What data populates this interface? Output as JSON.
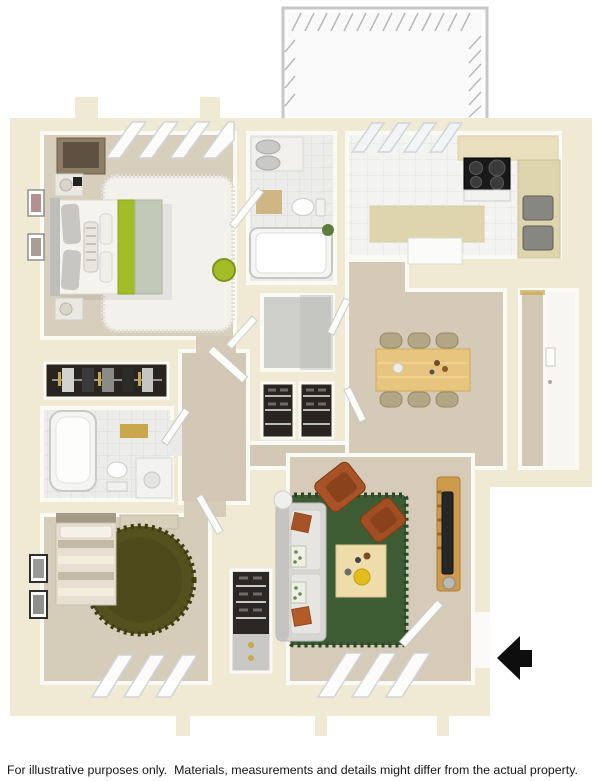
{
  "disclaimer": "For illustrative purposes only.  Materials, measurements and details might differ from the actual property.",
  "palette": {
    "background": "#ffffff",
    "wall_cream": "#f0ead5",
    "wall_face_white": "#fafaf5",
    "carpet_tan": "#d6ccba",
    "tile_white": "#ececea",
    "kitchen_tile": "#f3f3f1",
    "counter_beige": "#ded4ad",
    "wood_light": "#e7c57f",
    "lime_green": "#a3bd28",
    "sage_green": "#c3c9b8",
    "living_rug_green": "#3d5c33",
    "olive_rug": "#55511f",
    "rust_orange": "#a85327",
    "sofa_gray": "#d7d6d2",
    "closet_dark": "#29241f",
    "appliance_black": "#191919",
    "railing_gray": "#c7c7c7",
    "gold_accent": "#c9a84c",
    "arrow_black": "#0e0e0e"
  },
  "floor_plan": {
    "view": "3D top-down apartment floor plan rendering",
    "entry_arrow": {
      "direction": "left",
      "location": "outside right wall at entry door"
    },
    "rooms": [
      {
        "name": "balcony",
        "features": [
          "white deck",
          "railing with hatch marks"
        ]
      },
      {
        "name": "master-bedroom",
        "features": [
          "double bed with lime green runner",
          "white shag rug",
          "two nightstands with lamps",
          "dresser",
          "two wall art frames",
          "lime pouf",
          "windows on top wall"
        ]
      },
      {
        "name": "bathroom-1",
        "features": [
          "vanity with twin gray basins",
          "toilet",
          "bathtub",
          "plant",
          "tile floor",
          "open door"
        ]
      },
      {
        "name": "kitchen",
        "features": [
          "island counter",
          "black cooktop with oven",
          "double sink",
          "refrigerator",
          "white tile floor",
          "sliding glass door to balcony"
        ]
      },
      {
        "name": "dining-area",
        "features": [
          "light wood table",
          "six khaki chairs",
          "tableware"
        ]
      },
      {
        "name": "walk-in-closet",
        "features": [
          "empty gray floor"
        ]
      },
      {
        "name": "hall-closets",
        "features": [
          "two shelved closet bays"
        ]
      },
      {
        "name": "side-closet",
        "features": [
          "hanging clothes on gold rod"
        ]
      },
      {
        "name": "bathroom-2",
        "features": [
          "bathtub",
          "toilet",
          "vanity with stool",
          "gold towels",
          "tile floor"
        ]
      },
      {
        "name": "bedroom-2",
        "features": [
          "striped single bed",
          "round olive shag rug",
          "two picture frames",
          "windows on bottom wall"
        ]
      },
      {
        "name": "closet-3",
        "features": [
          "shelved and hanging storage"
        ]
      },
      {
        "name": "living-room",
        "features": [
          "gray sofa with orange and botanical pillows",
          "two rust armchairs",
          "wood coffee table",
          "green area rug",
          "tv console with tv",
          "round side table",
          "windows on bottom wall",
          "open entry door"
        ]
      },
      {
        "name": "entry-nook",
        "features": [
          "white vinyl floor",
          "wall panel"
        ]
      }
    ]
  }
}
